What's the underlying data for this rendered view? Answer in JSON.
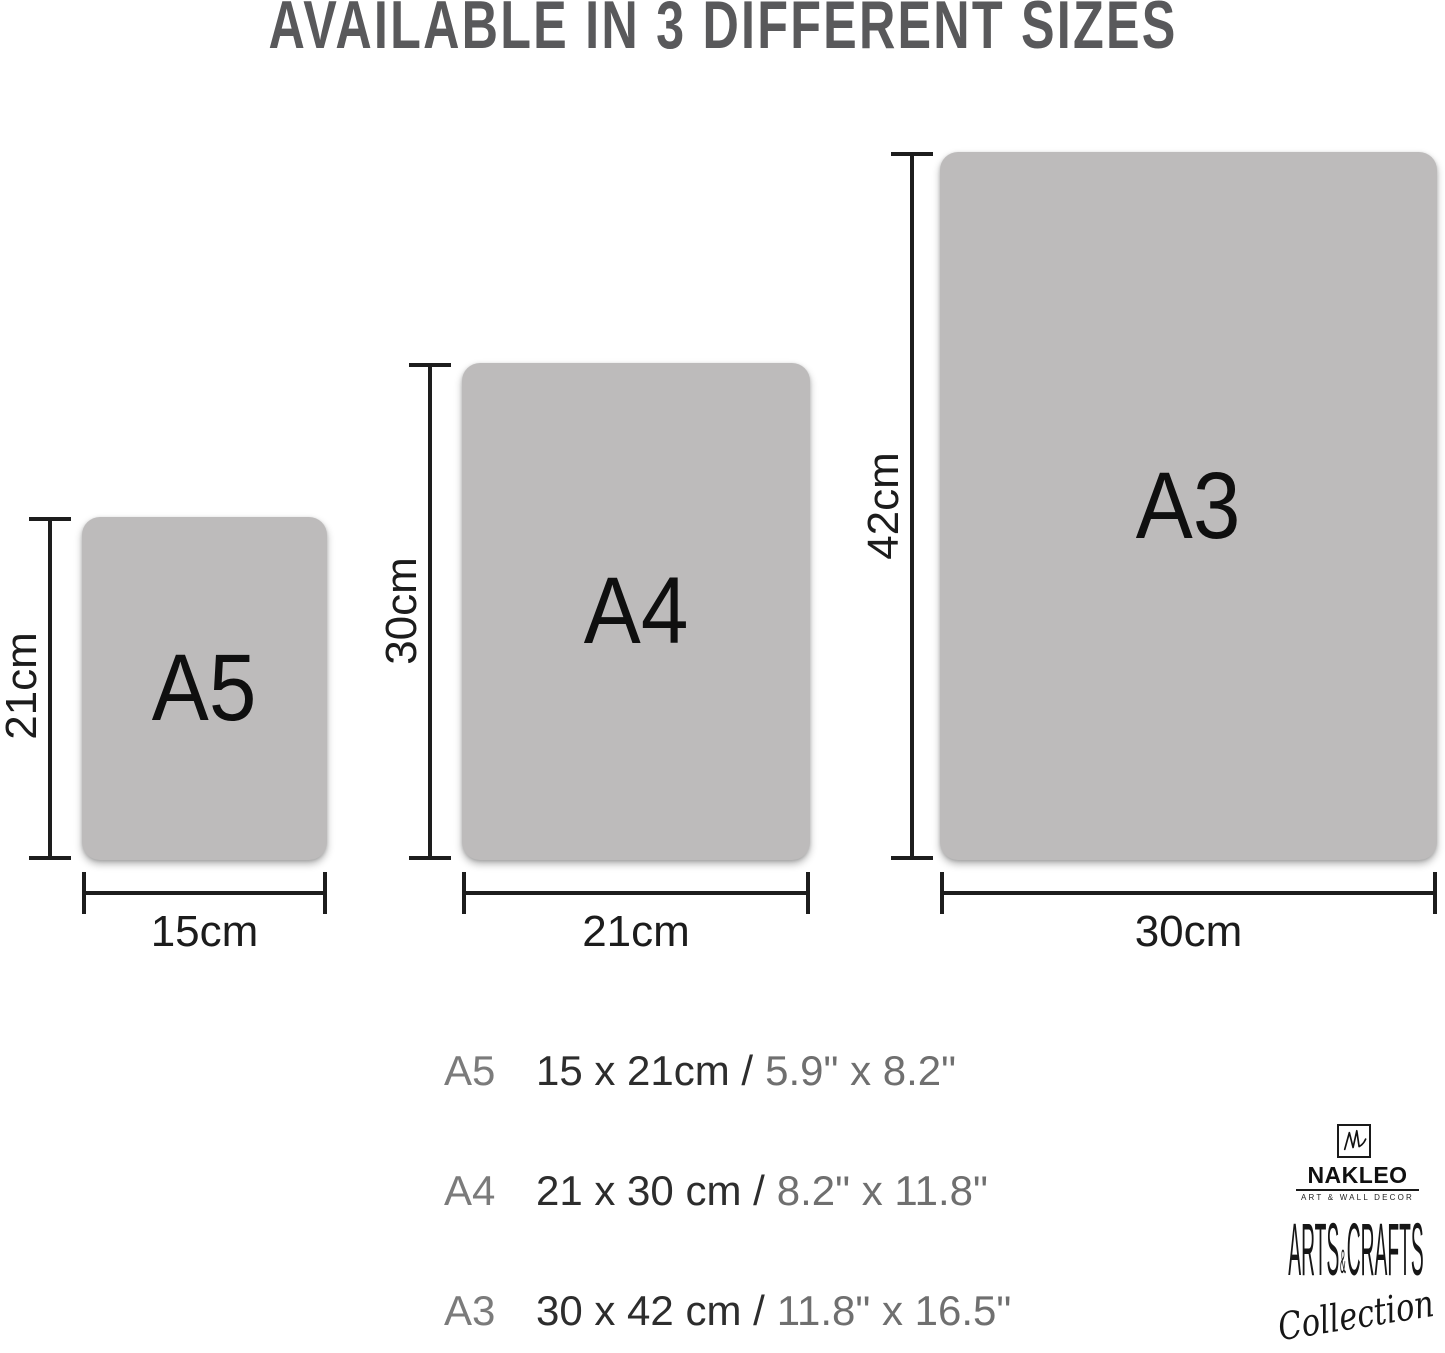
{
  "title": "AVAILABLE IN 3 DIFFERENT SIZES",
  "sizes": [
    {
      "name": "A5",
      "height_label": "21cm",
      "width_label": "15cm",
      "cm_text": "15 x 21cm /",
      "inch_text": "5.9\" x 8.2\""
    },
    {
      "name": "A4",
      "height_label": "30cm",
      "width_label": "21cm",
      "cm_text": "21 x 30 cm /",
      "inch_text": "8.2\" x 11.8\""
    },
    {
      "name": "A3",
      "height_label": "42cm",
      "width_label": "30cm",
      "cm_text": "30 x 42 cm /",
      "inch_text": "11.8\" x 16.5\""
    }
  ],
  "brand": {
    "monogram": "NL",
    "name": "NAKLEO",
    "tagline": "ART & WALL DECOR",
    "arts": "ARTS",
    "ampersand": "&",
    "crafts": "CRAFTS",
    "collection": "Collection"
  },
  "colors": {
    "paper_fill": "#bdbbbb",
    "dimension_line": "#1d1d1d",
    "title_text": "#59595b",
    "list_primary": "#2d2d2d",
    "list_secondary": "#6f6f6f"
  }
}
